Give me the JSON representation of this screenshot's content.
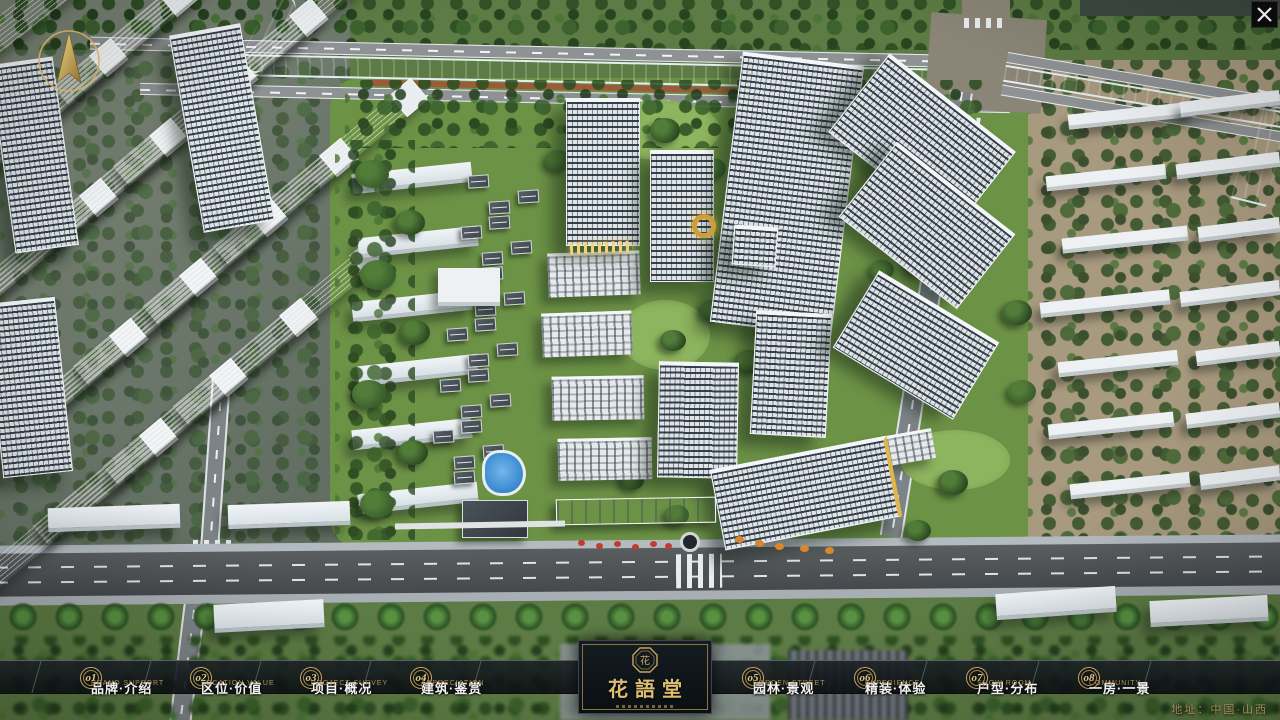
{
  "nav": {
    "items": [
      {
        "num": "o1",
        "cn": "品牌·介绍",
        "en": "BRAND SUPPORT"
      },
      {
        "num": "o2",
        "cn": "区位·价值",
        "en": "LOCATION VALUE"
      },
      {
        "num": "o3",
        "cn": "项目·概况",
        "en": "PROJECT SURVEY"
      },
      {
        "num": "o4",
        "cn": "建筑·鉴赏",
        "en": "APPRECIATION"
      },
      {
        "num": "o5",
        "cn": "园林·景观",
        "en": "GARDEN STREET"
      },
      {
        "num": "o6",
        "cn": "精装·体验",
        "en": "EXPERIENCE"
      },
      {
        "num": "o7",
        "cn": "户型·分布",
        "en": "SHOW ROOM"
      },
      {
        "num": "o8",
        "cn": "一房·一景",
        "en": "COMMUNITY"
      }
    ]
  },
  "logo": {
    "title": "花語堂"
  },
  "footer": {
    "address": "地址：中国·山西"
  },
  "icons": {
    "close_glyph": "✕",
    "compass": "compass-north-arrow",
    "seal": "octagonal-seal"
  },
  "colors": {
    "gold": "#c9a55e",
    "nav_cn": "#f2f2f2",
    "nav_en": "#b28e52",
    "bar_bg": "rgba(10,14,17,0.88)",
    "river": "#2e63c8",
    "green": "#6b9147"
  }
}
